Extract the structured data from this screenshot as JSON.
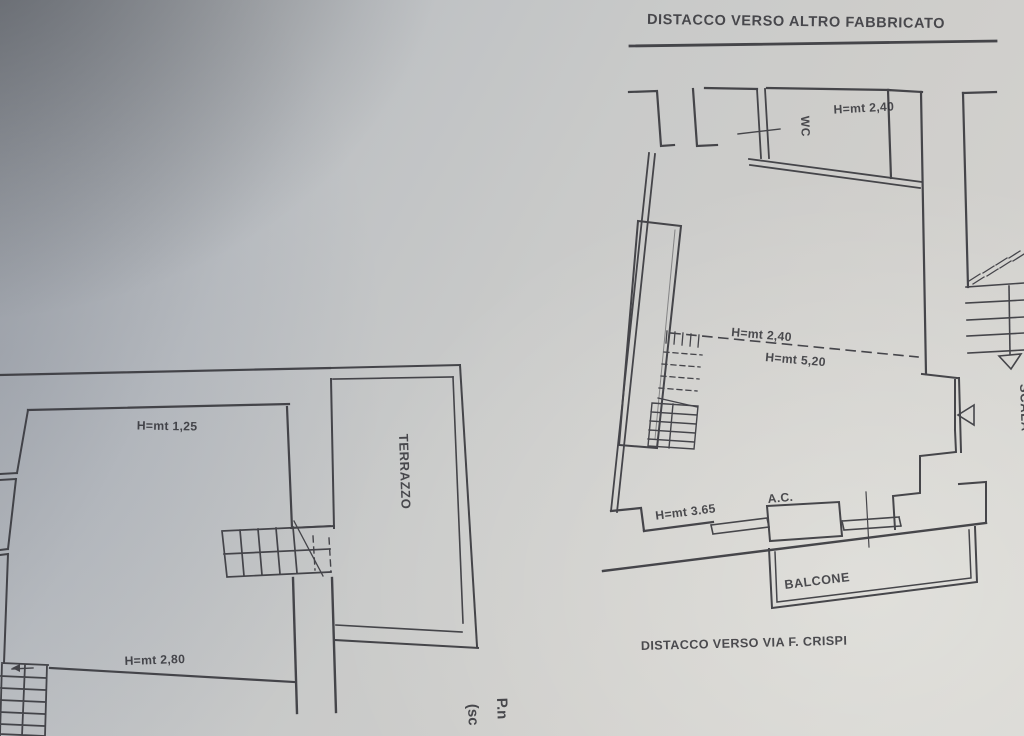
{
  "page": {
    "description": "Photographed scan of an Italian cadastral floor plan drawing",
    "paper_light": "#d6d5d1",
    "paper_shadow": "#85878b",
    "ink": "#3a3a40"
  },
  "boundaries": {
    "top_title": "DISTACCO VERSO ALTRO FABBRICATO",
    "bottom_title": "DISTACCO VERSO VIA F. CRISPI"
  },
  "main_plan": {
    "wc_room_height": "H=mt 2,40",
    "wc_label": "WC",
    "height_low": "H=mt 2,40",
    "height_high": "H=mt 5,20",
    "stairwell_label": "SCALA",
    "wall_height": "H=mt 3.65",
    "ac_label": "A.C.",
    "balcony_label": "BALCONE"
  },
  "left_plan": {
    "parapet_height": "H=mt 1,25",
    "terrace_label": "TERRAZZO",
    "room_height": "H=mt 2,80"
  },
  "partial_text": {
    "line1": "P.n",
    "line2": "(sc"
  }
}
